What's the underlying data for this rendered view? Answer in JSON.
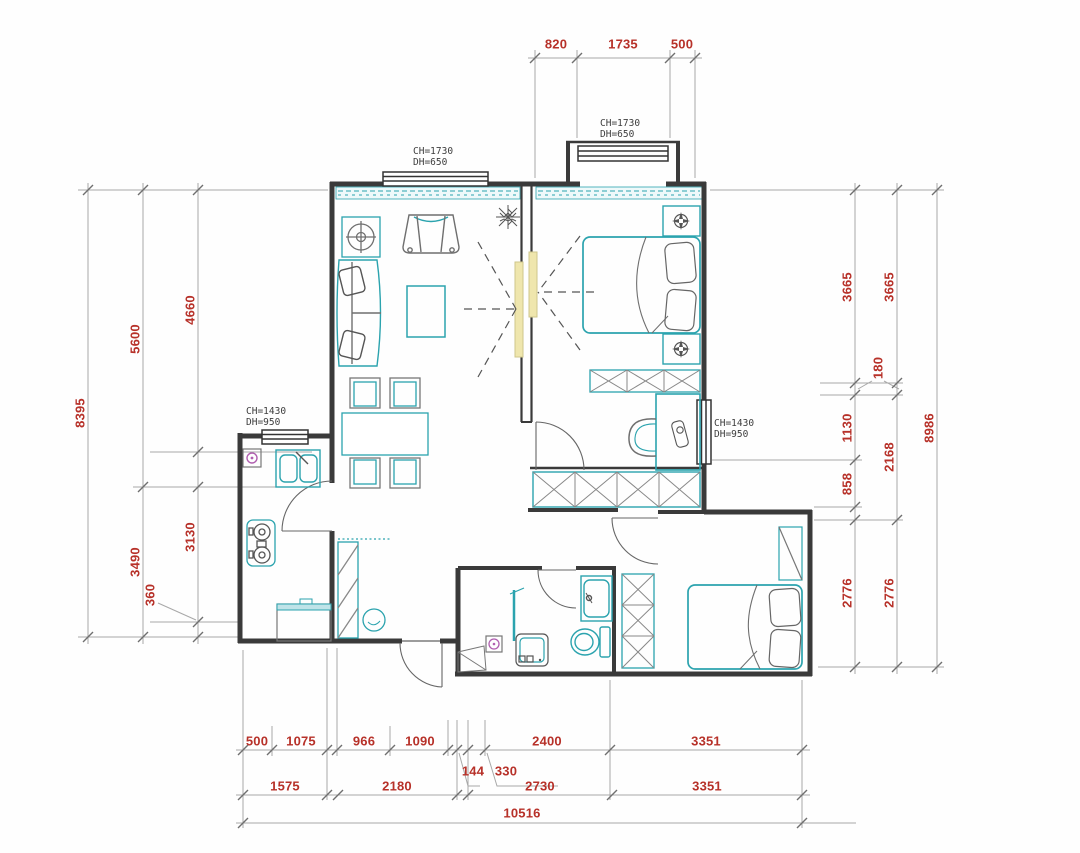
{
  "drawing": {
    "type": "residential floor plan",
    "units": "mm"
  },
  "palette": {
    "dimension_red": "#b73129",
    "wall": "#3a3a3a",
    "furniture_teal": "#2ba3ae",
    "furniture_gray": "#6f6f6f",
    "door_highlight": "#efe6ad",
    "accent_magenta": "#b05fb0",
    "dim_line_gray": "#9a9a9a"
  },
  "window_labels": {
    "living": {
      "ch": "CH=1730",
      "dh": "DH=650"
    },
    "bay": {
      "ch": "CH=1730",
      "dh": "DH=650"
    },
    "kitchen": {
      "ch": "CH=1430",
      "dh": "DH=950"
    },
    "bedroom": {
      "ch": "CH=1430",
      "dh": "DH=950"
    }
  },
  "dimensions": {
    "top": [
      "820",
      "1735",
      "500"
    ],
    "left_outer": [
      "8395"
    ],
    "left_middle": [
      "5600",
      "3490"
    ],
    "left_inner": [
      "4660",
      "3130",
      "360"
    ],
    "right_inner": [
      "3665",
      "180",
      "1130",
      "858",
      "2776"
    ],
    "right_middle": [
      "3665",
      "2168",
      "2776"
    ],
    "right_outer": [
      "8986"
    ],
    "bottom_row1": [
      "500",
      "1075",
      "966",
      "1090",
      "144",
      "330",
      "2400",
      "3351"
    ],
    "bottom_row2": [
      "1575",
      "2180",
      "2730",
      "3351"
    ],
    "bottom_total": [
      "10516"
    ]
  }
}
